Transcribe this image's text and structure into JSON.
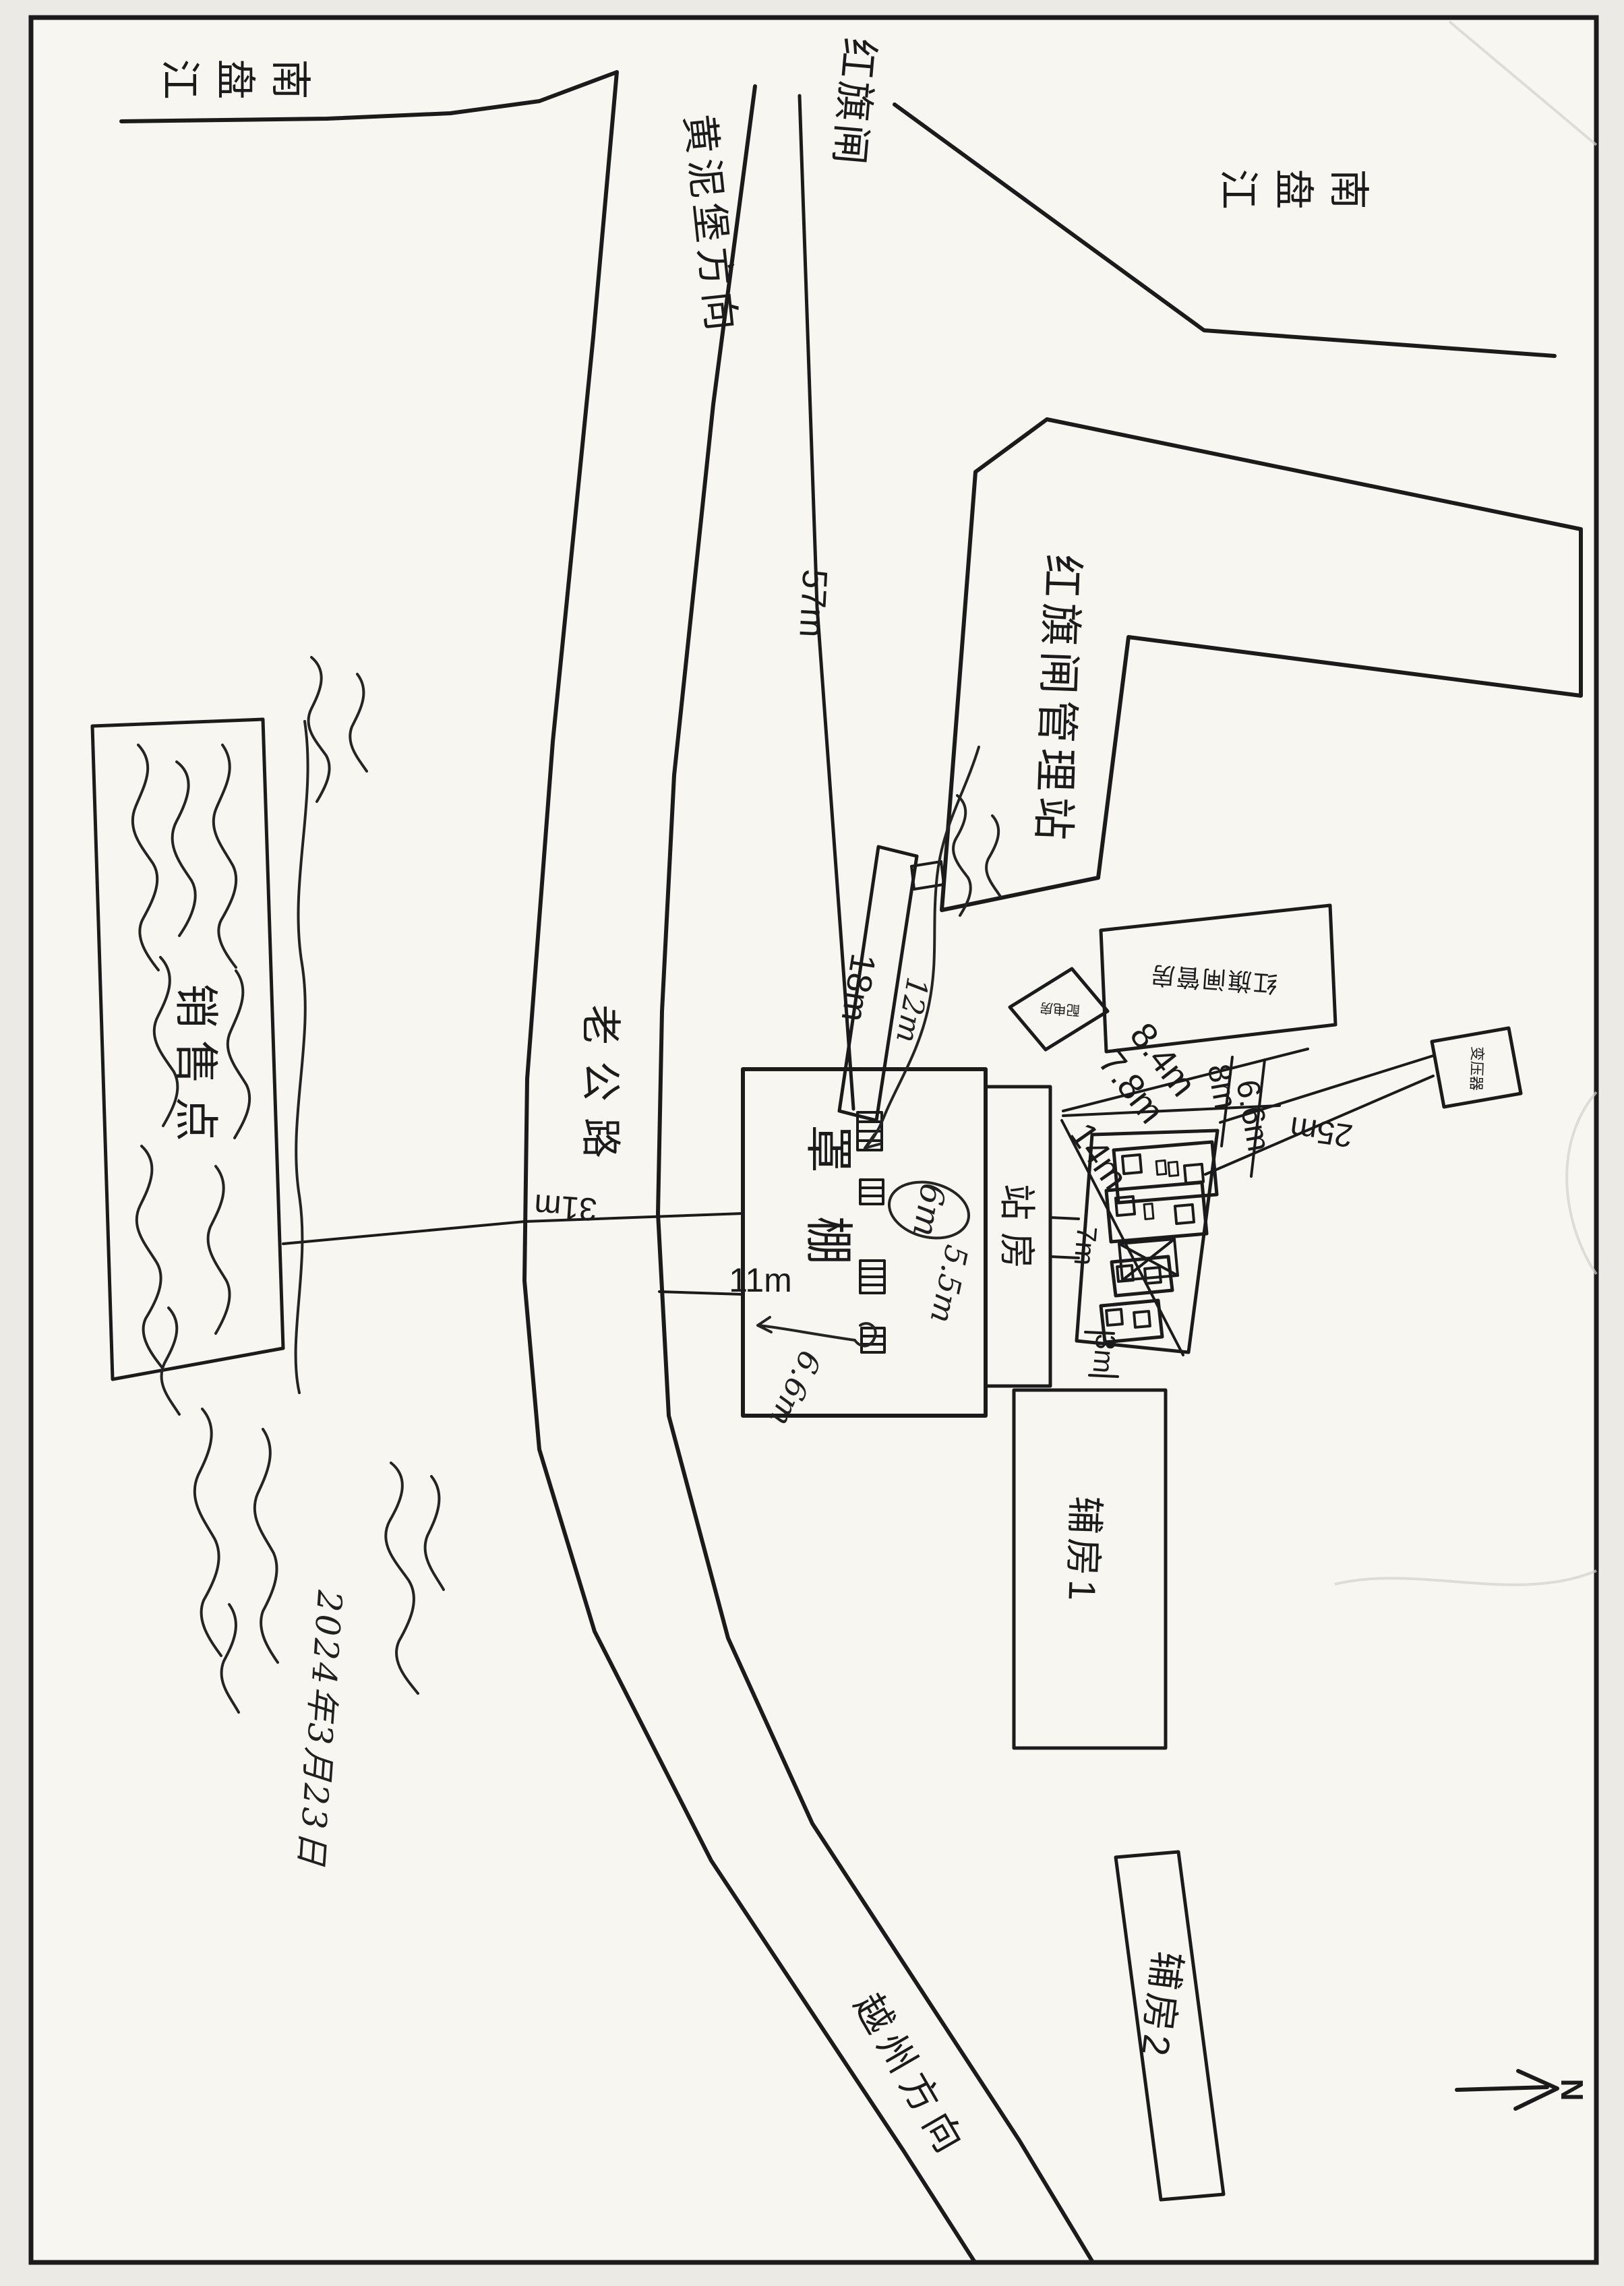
{
  "labels": {
    "river_top_left": "南盘江",
    "river_top_right": "南盘江",
    "gate": "红旗闸",
    "direction_huangnibao": "黄泥堡方向",
    "direction_yuezhou": "越州方向",
    "old_road": "老公路",
    "management_station": "红旗闸管理站",
    "management_house": "红旗闸管房",
    "power_room": "配电房",
    "transformer": "变压器",
    "canopy": "罩棚",
    "station_house": "站房",
    "aux_room_1": "辅房1",
    "aux_room_2": "辅房2",
    "sales_point": "销售点",
    "north": "N"
  },
  "dimensions": {
    "d_57": "57m",
    "d_18": "18m",
    "d_31": "31m",
    "d_11": "11m",
    "d_8_4": "8.4m",
    "d_7_8": "7.8m",
    "d_14": "14m",
    "d_8": "8m",
    "d_6_6": "6.6m",
    "d_25": "25m",
    "d_7": "7m",
    "d_3": "3m"
  },
  "handwritten": {
    "h_6m": "6m",
    "h_5_5m": "5.5m",
    "h_6_6m": "6.6m",
    "h_12m": "12m",
    "date": "2024年3月23日"
  }
}
